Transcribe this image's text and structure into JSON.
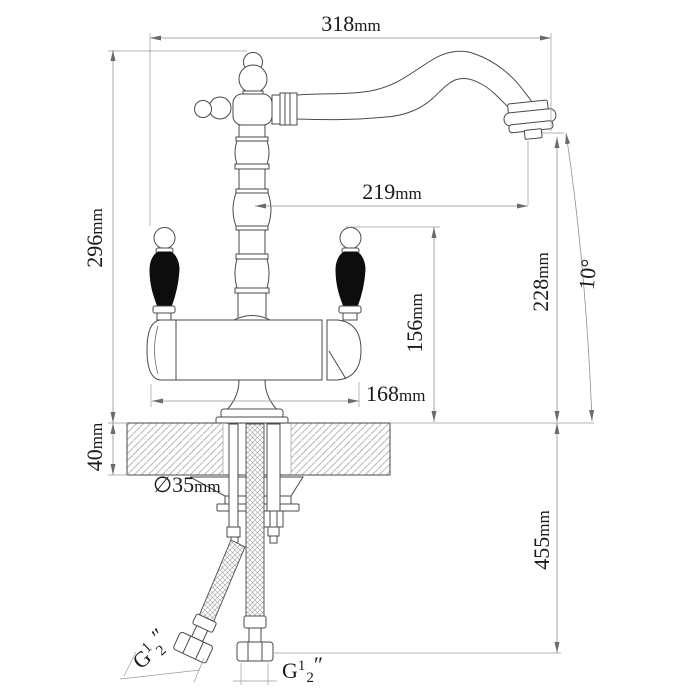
{
  "drawing": {
    "type": "faucet-installation-technical-drawing",
    "units": "mm"
  },
  "dims": {
    "d318": {
      "value": "318",
      "unit": "mm"
    },
    "d296": {
      "value": "296",
      "unit": "mm"
    },
    "d219": {
      "value": "219",
      "unit": "mm"
    },
    "d228": {
      "value": "228",
      "unit": "mm"
    },
    "d156": {
      "value": "156",
      "unit": "mm"
    },
    "d168": {
      "value": "168",
      "unit": "mm"
    },
    "d40": {
      "value": "40",
      "unit": "mm"
    },
    "d455": {
      "value": "455",
      "unit": "mm"
    },
    "hole": {
      "value": "∅35",
      "unit": "mm"
    },
    "angle": {
      "value": "10",
      "unit": "°"
    },
    "thread_left": {
      "prefix": "G",
      "numerator": "1",
      "denominator": "2",
      "suffix": "″"
    },
    "thread_bottom": {
      "prefix": "G",
      "numerator": "1",
      "denominator": "2",
      "suffix": "″"
    }
  },
  "colors": {
    "line": "#4a4a4a",
    "dimension_line": "#8f8f8f",
    "text": "#1a1a1a",
    "handle_fill": "#0d0d0d",
    "background": "#ffffff",
    "hatch": "#b8b8b8"
  }
}
